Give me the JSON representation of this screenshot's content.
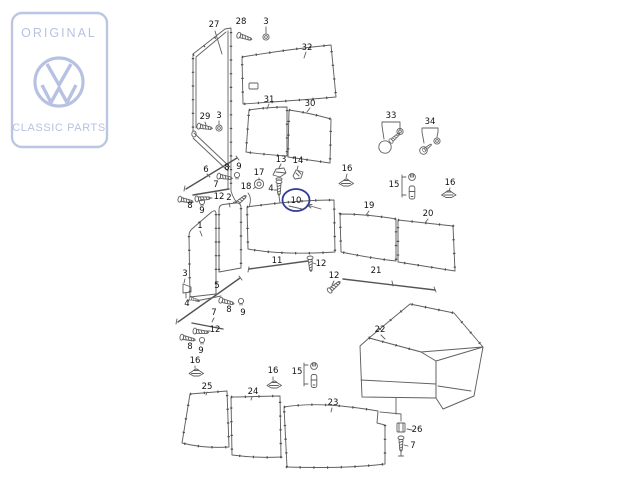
{
  "logo": {
    "line1": "ORIGINAL",
    "line2": "CLASSIC PARTS",
    "emblem": "vw-roundel",
    "color": "#b7c2e2"
  },
  "diagram": {
    "title": "exploded-view interior trim panels",
    "line_color": "#606060",
    "label_color": "#121212",
    "highlight_color": "#2e3c95",
    "selected_part": "10",
    "labels": [
      {
        "t": "27",
        "x": 214,
        "y": 27
      },
      {
        "t": "28",
        "x": 241,
        "y": 24
      },
      {
        "t": "3",
        "x": 266,
        "y": 24
      },
      {
        "t": "32",
        "x": 307,
        "y": 50
      },
      {
        "t": "31",
        "x": 269,
        "y": 102
      },
      {
        "t": "30",
        "x": 310,
        "y": 106
      },
      {
        "t": "29",
        "x": 205,
        "y": 119
      },
      {
        "t": "3",
        "x": 219,
        "y": 118
      },
      {
        "t": "33",
        "x": 391,
        "y": 118
      },
      {
        "t": "34",
        "x": 430,
        "y": 124
      },
      {
        "t": "6",
        "x": 206,
        "y": 172
      },
      {
        "t": "8",
        "x": 227,
        "y": 170
      },
      {
        "t": "9",
        "x": 239,
        "y": 169
      },
      {
        "t": "7",
        "x": 216,
        "y": 187
      },
      {
        "t": "12",
        "x": 219,
        "y": 199
      },
      {
        "t": "8",
        "x": 190,
        "y": 208
      },
      {
        "t": "9",
        "x": 202,
        "y": 213
      },
      {
        "t": "13",
        "x": 281,
        "y": 162
      },
      {
        "t": "14",
        "x": 298,
        "y": 163
      },
      {
        "t": "17",
        "x": 259,
        "y": 175
      },
      {
        "t": "18",
        "x": 246,
        "y": 189
      },
      {
        "t": "4",
        "x": 271,
        "y": 191
      },
      {
        "t": "2",
        "x": 229,
        "y": 200
      },
      {
        "t": "1",
        "x": 200,
        "y": 228
      },
      {
        "t": "16",
        "x": 347,
        "y": 171
      },
      {
        "t": "15",
        "x": 394,
        "y": 187
      },
      {
        "t": "16",
        "x": 450,
        "y": 185
      },
      {
        "t": "10",
        "x": 296,
        "y": 203
      },
      {
        "t": "19",
        "x": 369,
        "y": 208
      },
      {
        "t": "20",
        "x": 428,
        "y": 216
      },
      {
        "t": "11",
        "x": 277,
        "y": 263
      },
      {
        "t": "12",
        "x": 321,
        "y": 266
      },
      {
        "t": "12",
        "x": 334,
        "y": 278
      },
      {
        "t": "21",
        "x": 376,
        "y": 273
      },
      {
        "t": "3",
        "x": 185,
        "y": 276
      },
      {
        "t": "4",
        "x": 187,
        "y": 306
      },
      {
        "t": "5",
        "x": 217,
        "y": 288
      },
      {
        "t": "8",
        "x": 229,
        "y": 312
      },
      {
        "t": "9",
        "x": 243,
        "y": 315
      },
      {
        "t": "7",
        "x": 214,
        "y": 315
      },
      {
        "t": "12",
        "x": 215,
        "y": 332
      },
      {
        "t": "8",
        "x": 190,
        "y": 349
      },
      {
        "t": "9",
        "x": 201,
        "y": 353
      },
      {
        "t": "16",
        "x": 195,
        "y": 363
      },
      {
        "t": "25",
        "x": 207,
        "y": 389
      },
      {
        "t": "24",
        "x": 253,
        "y": 394
      },
      {
        "t": "23",
        "x": 333,
        "y": 405
      },
      {
        "t": "16",
        "x": 273,
        "y": 373
      },
      {
        "t": "15",
        "x": 297,
        "y": 374
      },
      {
        "t": "22",
        "x": 380,
        "y": 332
      },
      {
        "t": "26",
        "x": 417,
        "y": 432
      },
      {
        "t": "7",
        "x": 413,
        "y": 448
      }
    ]
  }
}
